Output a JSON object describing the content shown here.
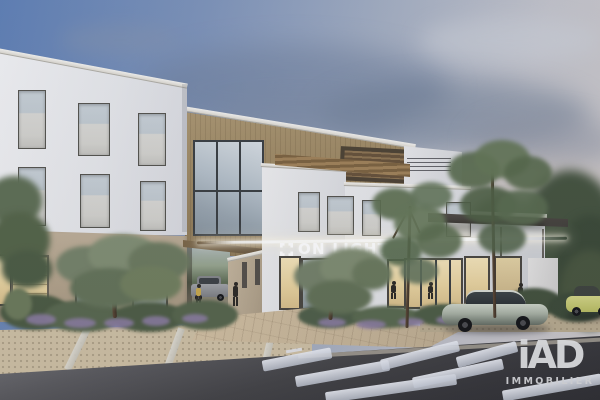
{
  "image": {
    "kind": "photorealistic architectural rendering",
    "setting": "modern three-storey office building at dusk with landscaped forecourt, gravel parking, road and pedestrian crossing"
  },
  "building": {
    "sign": {
      "text": "ON LIGHT",
      "icon": "square corner-bracket logo mark",
      "letter_color": "#ffffff",
      "effect": "illuminated channel letters with glowing LED strip across the facade"
    },
    "materials": {
      "upper_facade_white": "#e9eaec",
      "wood_cladding": "#9c8762",
      "ground_floor_render": "#b3a48c"
    }
  },
  "brand": {
    "name": "iAD",
    "tagline": "IMMOBILIER",
    "color": "#d5d6d9"
  },
  "environment": {
    "sky_top": "#5f7fb4",
    "sky_horizon": "#cdc9c9",
    "vehicles": [
      {
        "type": "sedan",
        "color": "#aab3a6",
        "location": "parked in front of building"
      },
      {
        "type": "hatchback",
        "color": "#c6ca74",
        "location": "right edge"
      },
      {
        "type": "suv",
        "color": "#96989c",
        "location": "inside passageway"
      }
    ],
    "pedestrians": 5,
    "road_surface": "#454548",
    "crosswalk_stripes": 7
  }
}
